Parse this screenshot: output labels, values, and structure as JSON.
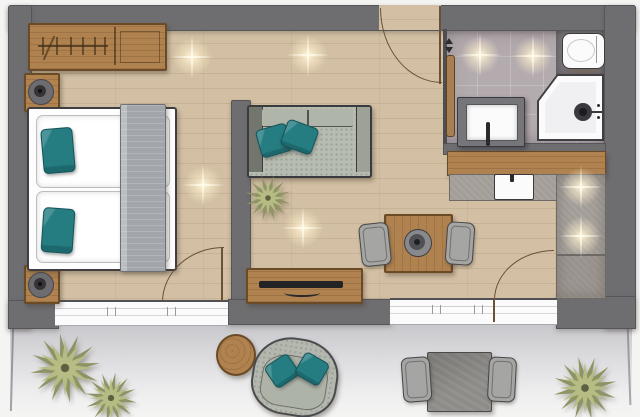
{
  "scene": {
    "type": "floor-plan",
    "description": "Top-down rendered floor plan of a studio apartment with bedroom area, living area, kitchenette, bathroom and terrace",
    "rooms": [
      "bedroom",
      "living-area",
      "kitchen",
      "bathroom",
      "terrace"
    ]
  },
  "colors": {
    "background": "#f4f4f3",
    "wall": "#6e6e71",
    "wall_dark": "#4c4c50",
    "floor_wood": "#d3c0a4",
    "furniture_wood": "#b0824f",
    "furniture_wood_dark": "#6b4a26",
    "bath_tile": "#b3abae",
    "counter_gray": "#a39d98",
    "sofa_gray": "#b7bcb1",
    "chair_gray": "#a5a5a3",
    "accent_teal": "#257d82",
    "plant_light": "#b7bc84",
    "plant_dark": "#8f9465",
    "white_goods": "#fbfbfb",
    "terrace_gray": "#cdcdd0"
  },
  "inventory": {
    "bedroom": [
      "wardrobe-with-hangers",
      "double-bed",
      "teal-pillows-x2",
      "gray-blanket-runner",
      "nightstand-x2",
      "table-lamp-x2"
    ],
    "living_area": [
      "sofa-with-teal-cushions",
      "indoor-plant",
      "sideboard-with-tv",
      "dining-table",
      "decorative-bowl",
      "dining-chair-x2"
    ],
    "kitchen": [
      "wood-bar-counter",
      "l-shaped-gray-counter",
      "sink"
    ],
    "bathroom": [
      "sliding-door",
      "toilet",
      "corner-shower",
      "vanity-with-basin"
    ],
    "terrace": [
      "round-side-table",
      "lounge-armchair-with-teal-cushions",
      "stone-dining-table",
      "outdoor-chair-x2",
      "plant-x3"
    ],
    "features": [
      "entrance-door-swing",
      "bedroom-door-swing",
      "patio-door-swing",
      "window-bedroom",
      "window-living",
      "ceiling-light-flares-x8"
    ]
  }
}
